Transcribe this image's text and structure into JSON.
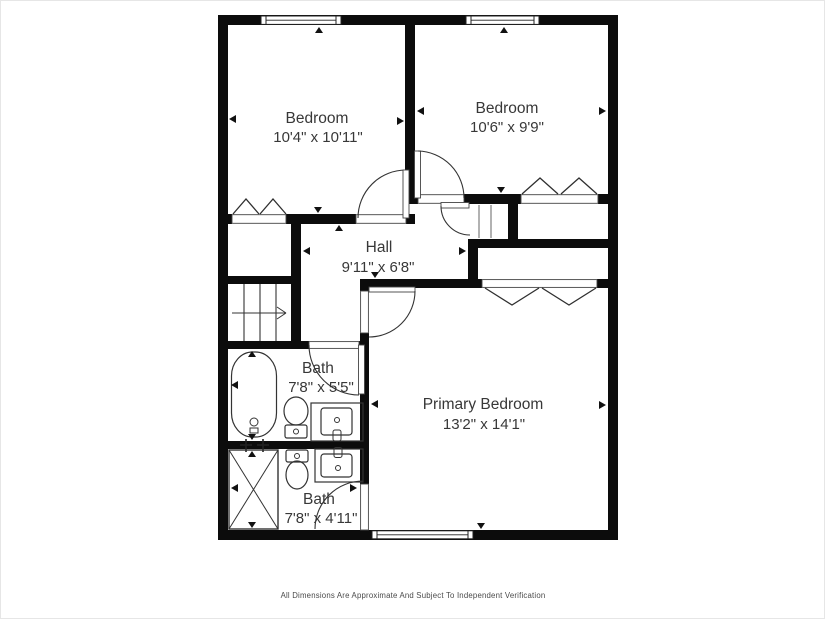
{
  "floor_plan": {
    "rooms": [
      {
        "id": "bedroom-1",
        "name": "Bedroom",
        "dimensions": "10'4\" x 10'11\""
      },
      {
        "id": "bedroom-2",
        "name": "Bedroom",
        "dimensions": "10'6\" x 9'9\""
      },
      {
        "id": "hall",
        "name": "Hall",
        "dimensions": "9'11\" x 6'8\""
      },
      {
        "id": "bath-1",
        "name": "Bath",
        "dimensions": "7'8\" x 5'5\""
      },
      {
        "id": "primary-bedroom",
        "name": "Primary Bedroom",
        "dimensions": "13'2\" x 14'1\""
      },
      {
        "id": "bath-2",
        "name": "Bath",
        "dimensions": "7'8\" x 4'11\""
      }
    ],
    "fixtures": [
      "bathtub",
      "toilet",
      "sink-vanity",
      "shower",
      "stairs",
      "closet-bifold-doors",
      "windows"
    ],
    "colors": {
      "wall": "#0c0c0c",
      "background": "#ffffff",
      "text": "#383838",
      "line": "#333333"
    },
    "footer": {
      "disclaimer": "All Dimensions Are Approximate And Subject To Independent Verification"
    }
  }
}
